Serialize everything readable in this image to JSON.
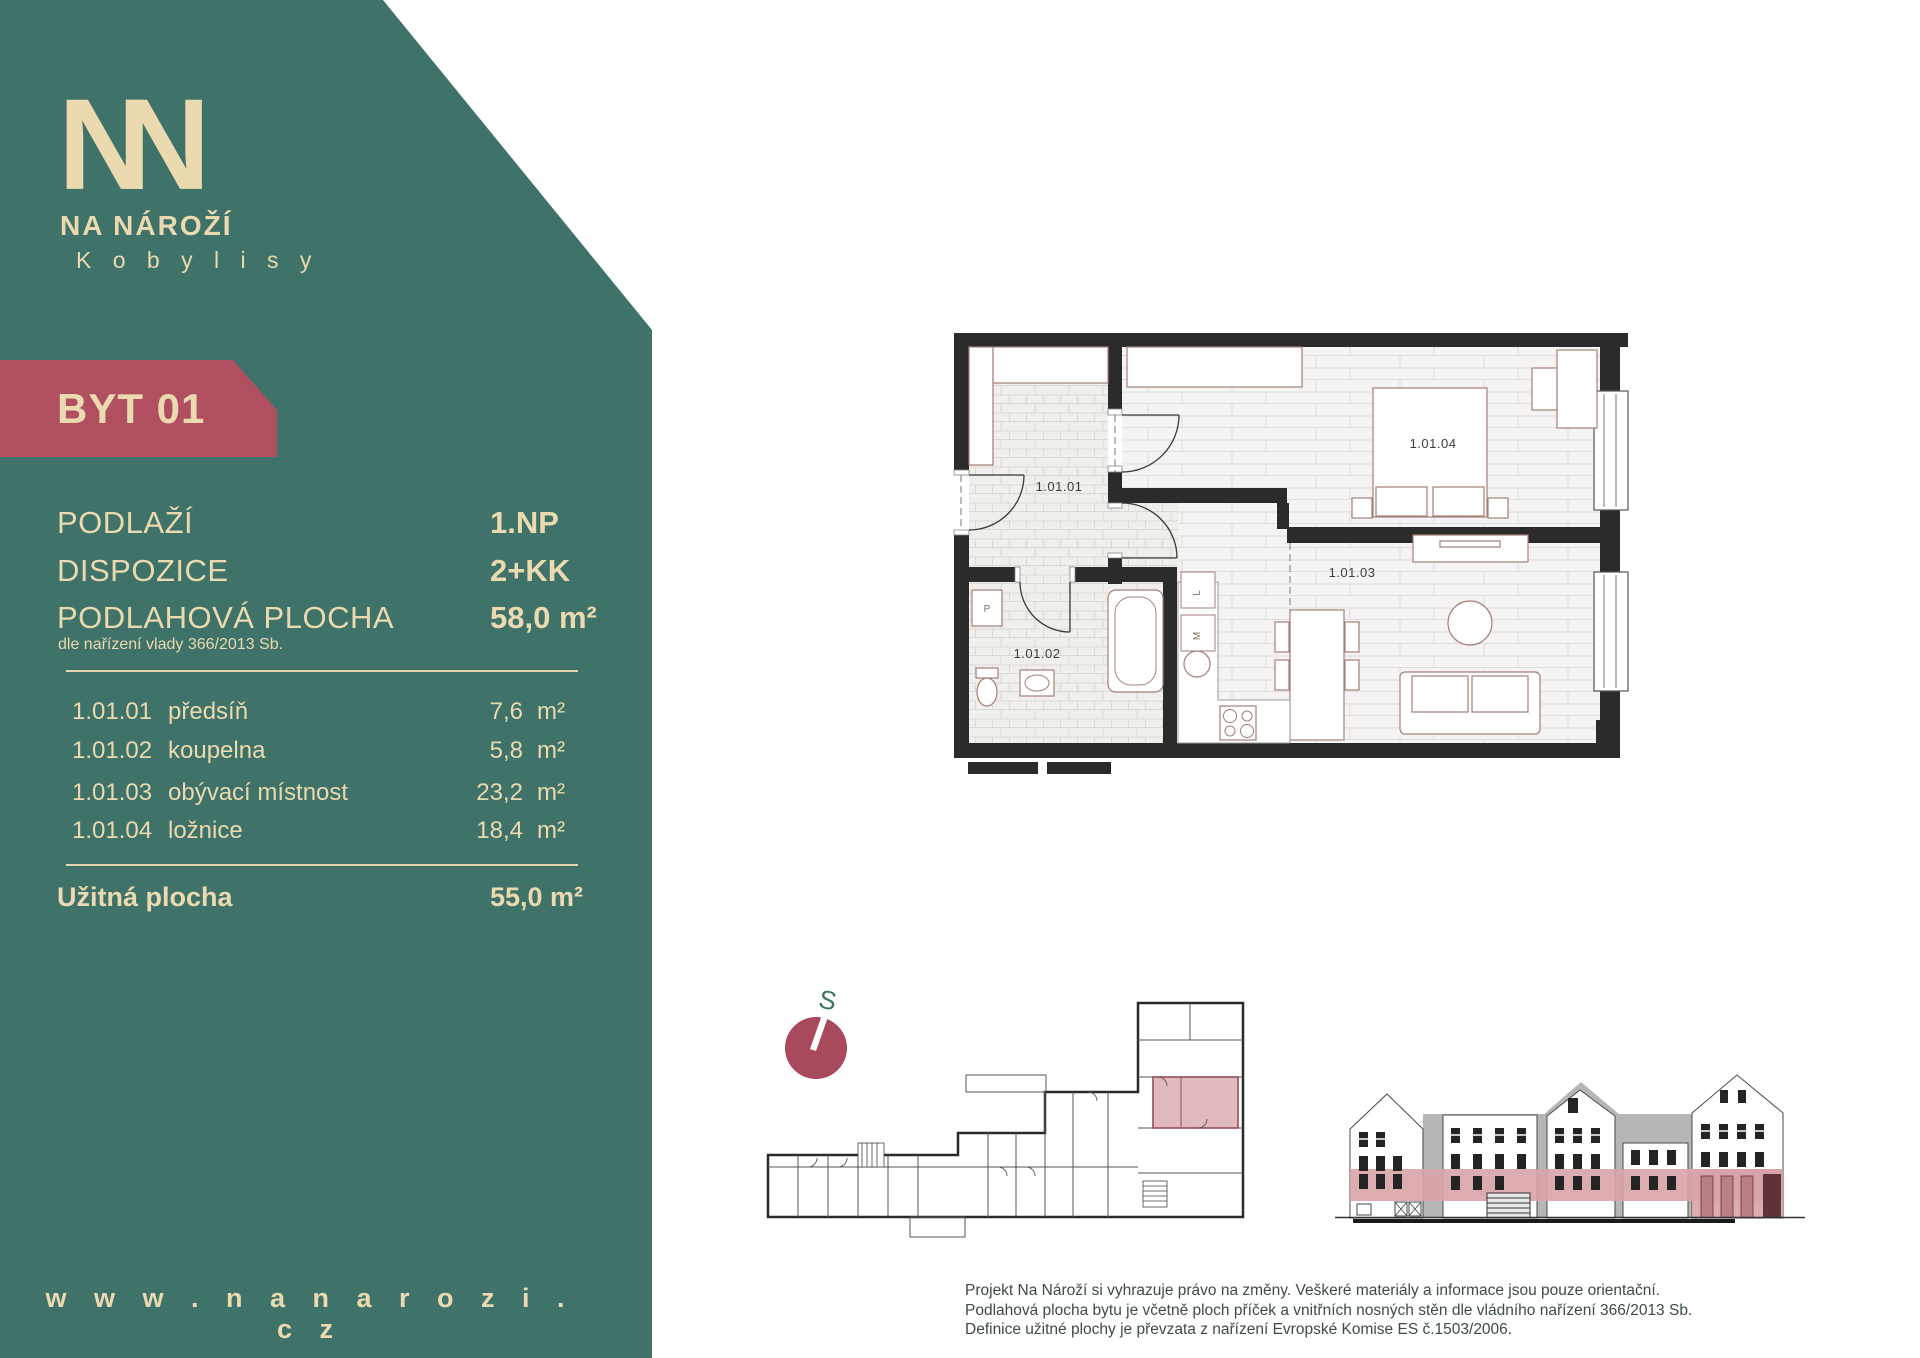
{
  "colors": {
    "teal": "#3F7268",
    "cream": "#EBD9AF",
    "badge_red": "#B04F60",
    "compass_red": "#A84A5C",
    "plan_highlight": "#E2B9BD",
    "elevation_pink": "#D8A3A8"
  },
  "logo": {
    "name": "NA NÁROŽÍ",
    "subtitle": "K o b y l i s y"
  },
  "badge": {
    "label": "BYT 01"
  },
  "info": {
    "rows": [
      {
        "label": "PODLAŽÍ",
        "value": "1.NP"
      },
      {
        "label": "DISPOZICE",
        "value": "2+KK"
      },
      {
        "label": "PODLAHOVÁ PLOCHA",
        "value": "58,0 m²"
      }
    ],
    "note": "dle nařízení vlady 366/2013 Sb."
  },
  "rooms": [
    {
      "code": "1.01.01",
      "name": "předsíň",
      "area": "7,6",
      "unit": "m²"
    },
    {
      "code": "1.01.02",
      "name": "koupelna",
      "area": "5,8",
      "unit": "m²"
    },
    {
      "code": "1.01.03",
      "name": "obývací místnost",
      "area": "23,2",
      "unit": "m²"
    },
    {
      "code": "1.01.04",
      "name": "ložnice",
      "area": "18,4",
      "unit": "m²"
    }
  ],
  "total": {
    "label": "Užitná plocha",
    "value": "55,0 m²"
  },
  "website": "w w w . n a n a r o z i . c z",
  "plan": {
    "labels": {
      "r1": "1.01.01",
      "r2": "1.01.02",
      "r3": "1.01.03",
      "r4": "1.01.04"
    },
    "fixtures": {
      "p": "P",
      "m": "M",
      "l": "L"
    }
  },
  "compass": {
    "north": "S"
  },
  "disclaimer": {
    "line1": "Projekt Na Nároží si vyhrazuje právo na změny. Veškeré materiály a informace jsou pouze orientační.",
    "line2": "Podlahová plocha bytu je včetně ploch příček a vnitřních nosných stěn dle vládního nařízení 366/2013 Sb.",
    "line3": "Definice užitné plochy je převzata z nařízení Evropské Komise ES č.1503/2006."
  }
}
